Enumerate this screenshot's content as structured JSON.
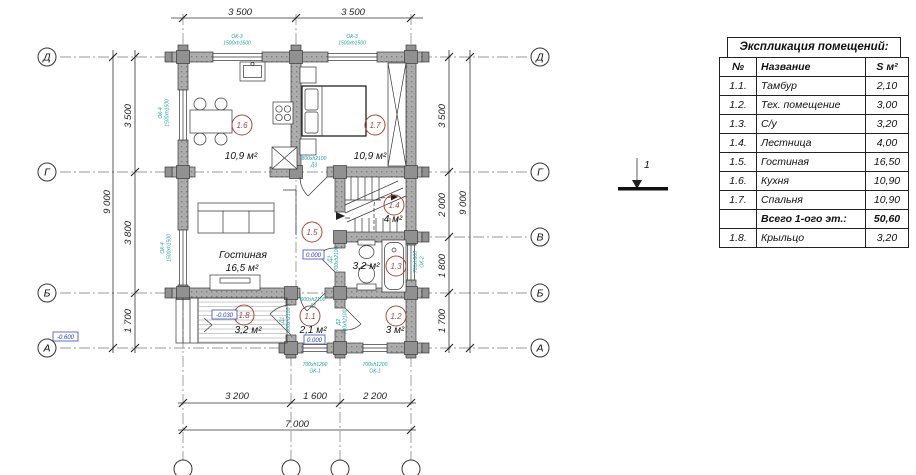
{
  "schedule": {
    "title": "Экспликация помещений:",
    "col_num": "№",
    "col_name": "Название",
    "col_area": "S м²",
    "rows": [
      {
        "num": "1.1.",
        "name": "Тамбур",
        "area": "2,10"
      },
      {
        "num": "1.2.",
        "name": "Тех. помещение",
        "area": "3,00"
      },
      {
        "num": "1.3.",
        "name": "С/у",
        "area": "3,20"
      },
      {
        "num": "1.4.",
        "name": "Лестница",
        "area": "4,00"
      },
      {
        "num": "1.5.",
        "name": "Гостиная",
        "area": "16,50"
      },
      {
        "num": "1.6.",
        "name": "Кухня",
        "area": "10,90"
      },
      {
        "num": "1.7.",
        "name": "Спальня",
        "area": "10,90"
      }
    ],
    "total_label": "Всего 1-ого эт.:",
    "total_value": "50,60",
    "extra_row": {
      "num": "1.8.",
      "name": "Крыльцо",
      "area": "3,20"
    }
  },
  "axes": {
    "left": [
      "Д",
      "Г",
      "Б",
      "А"
    ],
    "right": [
      "Д",
      "Г",
      "В",
      "Б",
      "А"
    ]
  },
  "dims": {
    "top": [
      "3 500",
      "3 500"
    ],
    "left_overall": "9 000",
    "left_segments": [
      "3 500",
      "3 800",
      "1 700"
    ],
    "right_overall": "9 000",
    "right_segments": [
      "3 500",
      "2 000",
      "1 800",
      "1 700"
    ],
    "bottom_segments": [
      "3 200",
      "1 600",
      "2 200"
    ],
    "bottom_overall": "7 000"
  },
  "tags": {
    "kitchen": {
      "no": "1.6",
      "area": "10,9 м²"
    },
    "bedroom": {
      "no": "1.7",
      "area": "10,9 м²"
    },
    "living": {
      "no": "1.5",
      "name": "Гостиная",
      "area": "16,5 м²"
    },
    "stairs": {
      "no": "1.4",
      "area": "4 м²"
    },
    "bath": {
      "no": "1.3",
      "area": "3,2 м²"
    },
    "tambour": {
      "no": "1.1",
      "area": "2,1 м²"
    },
    "tech": {
      "no": "1.2",
      "area": "3 м²"
    },
    "porch": {
      "no": "1.8",
      "area": "3,2 м²"
    }
  },
  "marks": {
    "ok3a": {
      "mark": "ОК-3",
      "size": "1500xh1500"
    },
    "ok3b": {
      "mark": "ОК-3",
      "size": "1500xh1500"
    },
    "ok4a": {
      "mark": "ОК-4",
      "size": "1500xh1500"
    },
    "ok4b": {
      "mark": "ОК-4",
      "size": "1500xh1500"
    },
    "ok2": {
      "mark": "ОК-2",
      "size": "700xh900"
    },
    "ok1a": {
      "mark": "ОК-1",
      "size": "700xh1200"
    },
    "ok1b": {
      "mark": "ОК-1",
      "size": "700xh1200"
    },
    "d1a": {
      "mark": "Д1",
      "size": "900xh2100"
    },
    "d1b": {
      "mark": "Д1",
      "size": "900xh2100"
    },
    "d2a": {
      "mark": "Д2",
      "size": "700xh2100"
    },
    "d2b": {
      "mark": "Д2",
      "size": "700xh2100"
    },
    "d3": {
      "mark": "Д3",
      "size": "800xh2100"
    }
  },
  "levels": {
    "living": "0.000",
    "tambour": "0.000",
    "porch": "-0.030",
    "ground": "-0.600"
  },
  "section": {
    "label": "1"
  },
  "colors": {
    "wall_fill": "#adadad",
    "opening_mark_teal": "#1d9c9c",
    "room_tag_red": "#a5493a",
    "level_blue": "#2633cc"
  }
}
